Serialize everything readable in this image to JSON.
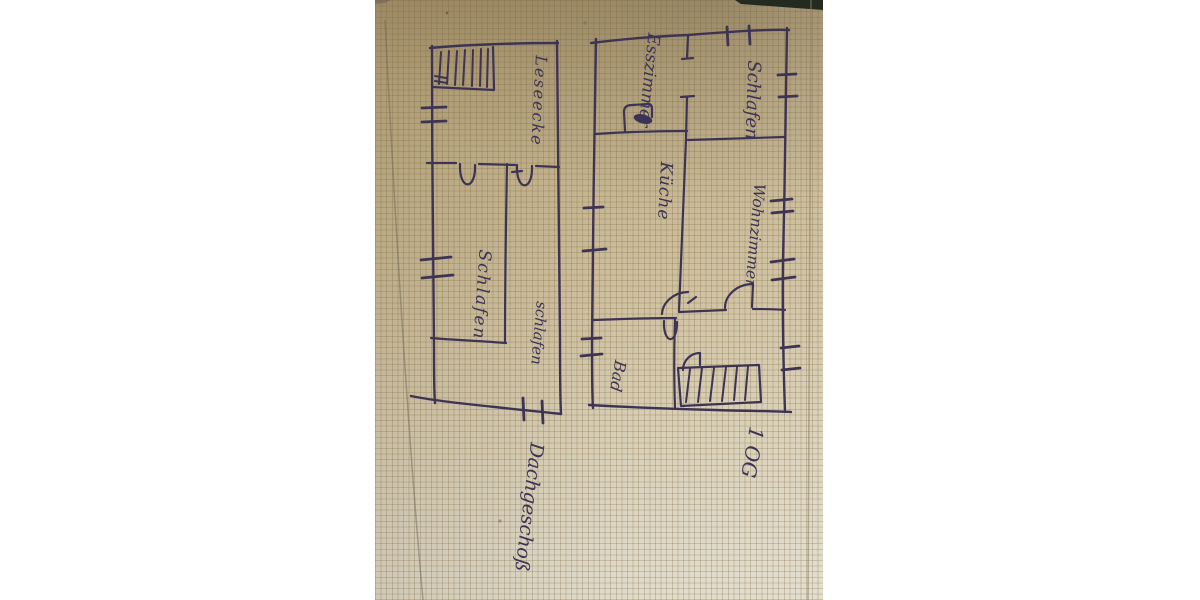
{
  "upper_floor_plan": {
    "floor_label": "1 OG",
    "room_esszimmer": "Esszimmer",
    "room_schlafen": "Schlafen",
    "room_kueche": "Küche",
    "room_wohnzimmer": "Wohnzimmer",
    "room_bad": "Bad"
  },
  "attic_plan": {
    "floor_label": "Dachgeschoß",
    "area_leseecke": "Leseecke",
    "room_schlafen_1": "Schlafen",
    "room_schlafen_2": "schlafen"
  },
  "colors": {
    "ink": "#3d3455",
    "paper_top": "#a7946d",
    "paper_bottom": "#dfd9c8",
    "grid_line": "#766434",
    "background": "#ffffff",
    "dark_edge": "#232a1f"
  }
}
